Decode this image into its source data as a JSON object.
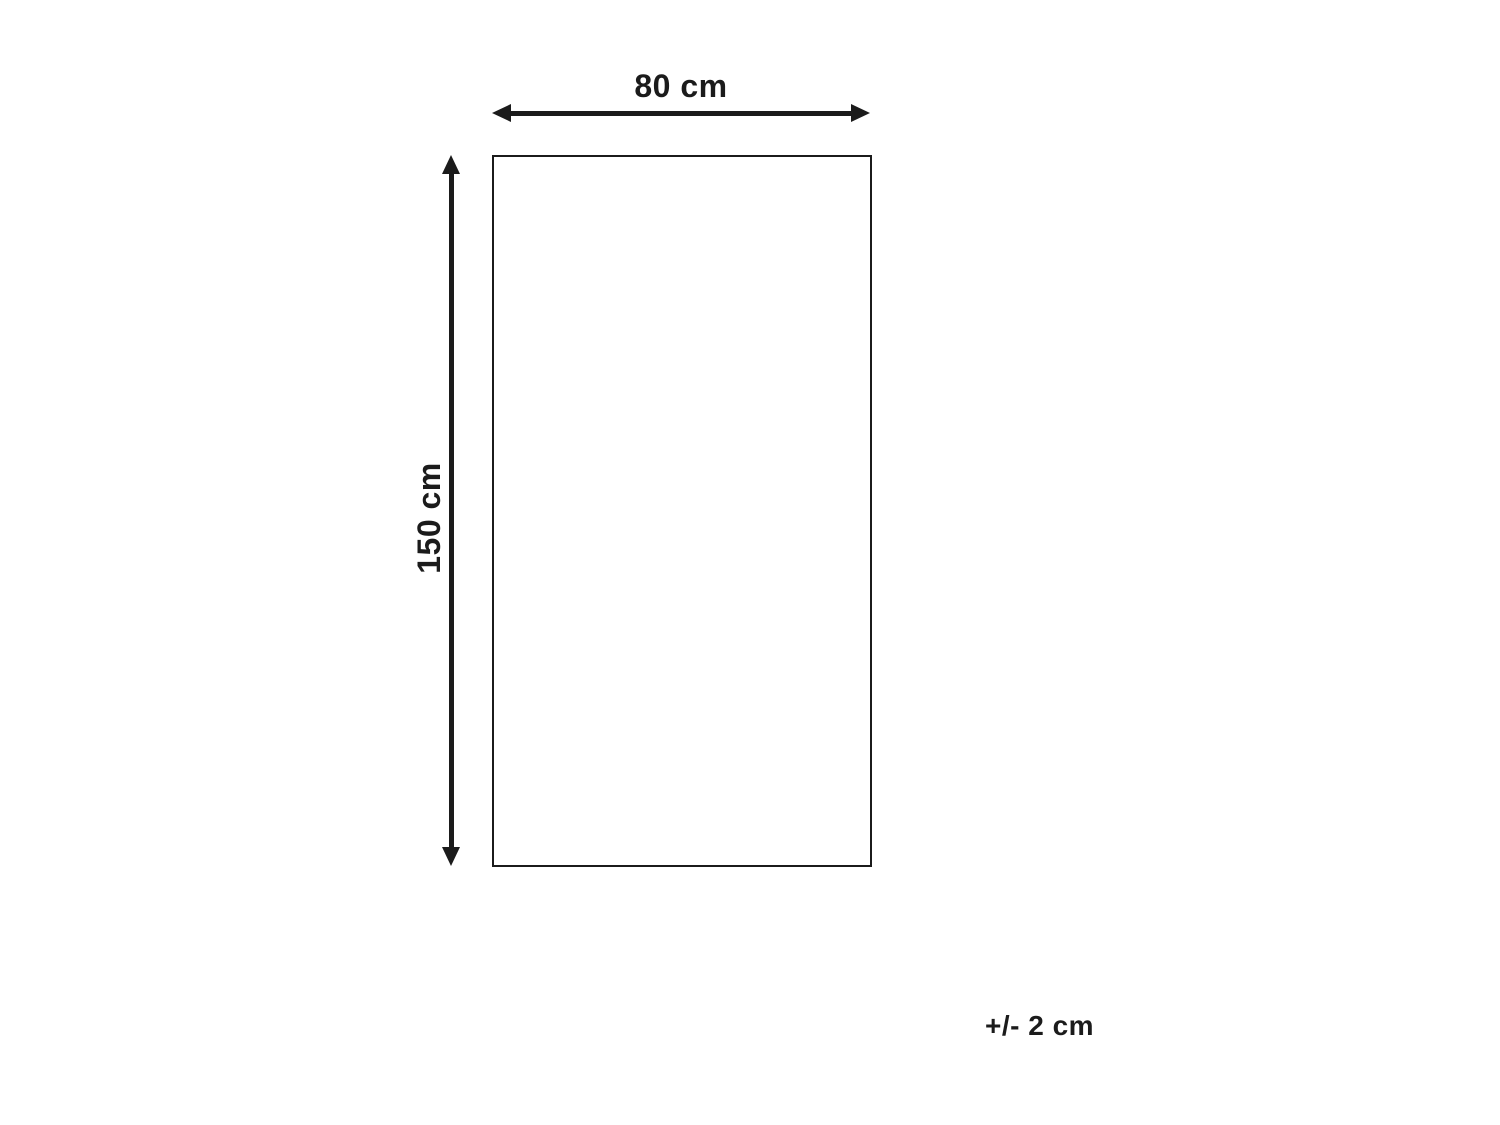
{
  "diagram": {
    "width_label": "80 cm",
    "height_label": "150 cm",
    "tolerance_label": "+/- 2 cm"
  },
  "colors": {
    "bg": "#ffffff",
    "line": "#1b1b1b",
    "text": "#1b1b1b"
  }
}
